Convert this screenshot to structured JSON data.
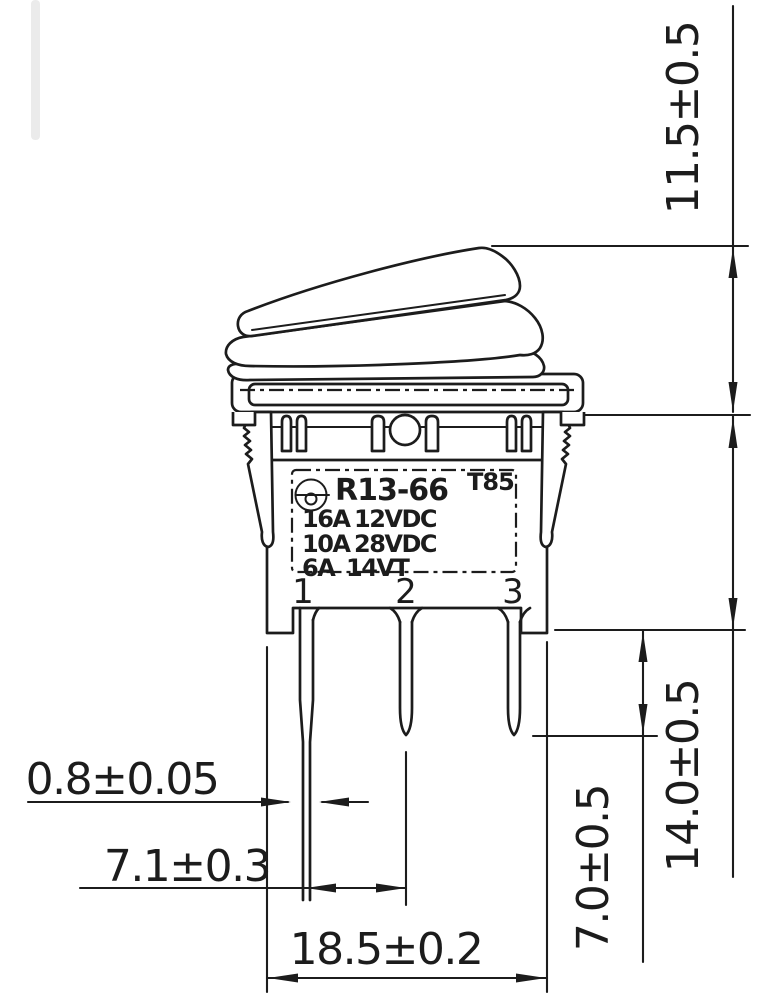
{
  "meta": {
    "paper_color": "#ffffff",
    "ink_color": "#1c1c1c",
    "drawing_type": "waterproof rocker switch side-view dimensional drawing"
  },
  "switch_label": {
    "mark_icon": "safety-certification-mark",
    "model": "R13-66",
    "temp_rating": "T85",
    "ratings": [
      {
        "current": "16A",
        "voltage": "12VDC"
      },
      {
        "current": "10A",
        "voltage": "28VDC"
      },
      {
        "current": "6A",
        "voltage": "14VT"
      }
    ]
  },
  "pins": {
    "labels": [
      "1",
      "2",
      "3"
    ]
  },
  "dimensions": {
    "actuator_height": "11.5±0.5",
    "housing_depth": "14.0±0.5",
    "terminal_length": "7.0±0.5",
    "terminal_thickness": "0.8±0.05",
    "terminal_pitch": "7.1±0.3",
    "body_width": "18.5±0.2"
  }
}
